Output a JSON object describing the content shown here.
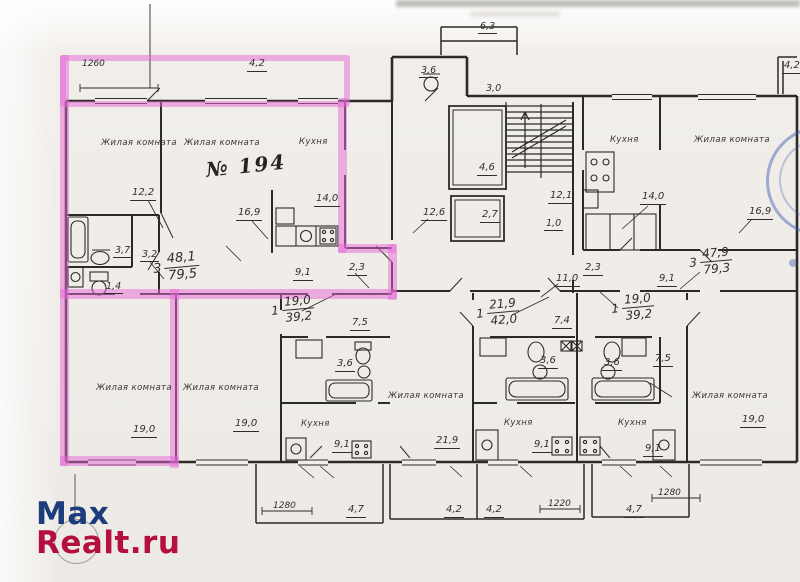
{
  "colors": {
    "highlight": "rgba(230,104,215,0.5)",
    "ink": "#2b2a27",
    "stamp_blue": "rgba(56,88,172,0.45)",
    "watermark_blue": "#1d3c7c",
    "watermark_red": "#b30f3f"
  },
  "watermark": {
    "line1": "Max",
    "line2": "Realt.ru"
  },
  "plan": {
    "apartment_number": "№ 194",
    "labels": [
      {
        "t": "1260",
        "x": 82,
        "y": 60,
        "fs": 9
      },
      {
        "t": "4,2",
        "x": 247,
        "y": 59,
        "fs": 10,
        "u": 1
      },
      {
        "t": "Жилая комната",
        "x": 101,
        "y": 139,
        "fs": 8.5,
        "room": 1
      },
      {
        "t": "Жилая комната",
        "x": 184,
        "y": 139,
        "fs": 8.5,
        "room": 1
      },
      {
        "t": "Кухня",
        "x": 299,
        "y": 138,
        "fs": 8.5,
        "room": 1
      },
      {
        "t": "№ 194",
        "x": 205,
        "y": 160,
        "fs": 20,
        "script": 1,
        "rot": -6
      },
      {
        "t": "12,2",
        "x": 130,
        "y": 188,
        "fs": 10,
        "u": 1
      },
      {
        "t": "16,9",
        "x": 236,
        "y": 208,
        "fs": 10,
        "u": 1
      },
      {
        "t": "14,0",
        "x": 314,
        "y": 194,
        "fs": 10,
        "u": 1
      },
      {
        "t": "3,7",
        "x": 113,
        "y": 246,
        "fs": 9.5,
        "u": 1
      },
      {
        "t": "3,2",
        "x": 140,
        "y": 250,
        "fs": 9.5,
        "u": 1
      },
      {
        "t": "1,4",
        "x": 104,
        "y": 282,
        "fs": 9.5,
        "u": 1
      },
      {
        "t": "9,1",
        "x": 293,
        "y": 268,
        "fs": 10,
        "u": 1
      },
      {
        "t": "2,3",
        "x": 347,
        "y": 263,
        "fs": 10,
        "u": 1
      },
      {
        "t": "7,5",
        "x": 350,
        "y": 318,
        "fs": 10,
        "u": 1
      },
      {
        "t": "3,6",
        "x": 335,
        "y": 359,
        "fs": 10,
        "u": 1
      },
      {
        "t": "Жилая комната",
        "x": 96,
        "y": 384,
        "fs": 8.5,
        "room": 1
      },
      {
        "t": "19,0",
        "x": 131,
        "y": 425,
        "fs": 10,
        "u": 1
      },
      {
        "t": "Жилая комната",
        "x": 183,
        "y": 384,
        "fs": 8.5,
        "room": 1
      },
      {
        "t": "19,0",
        "x": 233,
        "y": 419,
        "fs": 10,
        "u": 1
      },
      {
        "t": "Кухня",
        "x": 301,
        "y": 420,
        "fs": 8.5,
        "room": 1
      },
      {
        "t": "9,1",
        "x": 332,
        "y": 440,
        "fs": 10,
        "u": 1
      },
      {
        "t": "Жилая комната",
        "x": 388,
        "y": 392,
        "fs": 8.5,
        "room": 1
      },
      {
        "t": "21,9",
        "x": 434,
        "y": 436,
        "fs": 10,
        "u": 1
      },
      {
        "t": "7,4",
        "x": 552,
        "y": 316,
        "fs": 10,
        "u": 1
      },
      {
        "t": "3,6",
        "x": 538,
        "y": 356,
        "fs": 10,
        "u": 1
      },
      {
        "t": "3,6",
        "x": 602,
        "y": 358,
        "fs": 10,
        "u": 1
      },
      {
        "t": "Кухня",
        "x": 504,
        "y": 419,
        "fs": 8.5,
        "room": 1
      },
      {
        "t": "9,1",
        "x": 532,
        "y": 440,
        "fs": 10,
        "u": 1
      },
      {
        "t": "Кухня",
        "x": 618,
        "y": 419,
        "fs": 8.5,
        "room": 1
      },
      {
        "t": "9,1",
        "x": 643,
        "y": 444,
        "fs": 10,
        "u": 1
      },
      {
        "t": "11,0",
        "x": 554,
        "y": 274,
        "fs": 10,
        "u": 1
      },
      {
        "t": "2,3",
        "x": 583,
        "y": 263,
        "fs": 10,
        "u": 1
      },
      {
        "t": "9,1",
        "x": 657,
        "y": 274,
        "fs": 10,
        "u": 1
      },
      {
        "t": "7,5",
        "x": 653,
        "y": 354,
        "fs": 10,
        "u": 1
      },
      {
        "t": "Жилая комната",
        "x": 692,
        "y": 392,
        "fs": 8.5,
        "room": 1
      },
      {
        "t": "19,0",
        "x": 740,
        "y": 415,
        "fs": 10,
        "u": 1
      },
      {
        "t": "3,6",
        "x": 419,
        "y": 66,
        "fs": 9.5,
        "u": 1
      },
      {
        "t": "3,0",
        "x": 484,
        "y": 84,
        "fs": 9.5,
        "u": 1
      },
      {
        "t": "6,3",
        "x": 478,
        "y": 22,
        "fs": 9.5,
        "u": 1
      },
      {
        "t": "4,6",
        "x": 477,
        "y": 163,
        "fs": 10,
        "u": 1
      },
      {
        "t": "2,7",
        "x": 480,
        "y": 210,
        "fs": 10,
        "u": 1
      },
      {
        "t": "12,6",
        "x": 421,
        "y": 208,
        "fs": 10,
        "u": 1
      },
      {
        "t": "12,1",
        "x": 548,
        "y": 191,
        "fs": 10,
        "u": 1
      },
      {
        "t": "1,0",
        "x": 544,
        "y": 219,
        "fs": 9.5,
        "u": 1
      },
      {
        "t": "Кухня",
        "x": 610,
        "y": 136,
        "fs": 8.5,
        "room": 1
      },
      {
        "t": "Жилая комната",
        "x": 694,
        "y": 136,
        "fs": 8.5,
        "room": 1
      },
      {
        "t": "14,0",
        "x": 640,
        "y": 192,
        "fs": 10,
        "u": 1
      },
      {
        "t": "16,9",
        "x": 747,
        "y": 207,
        "fs": 10,
        "u": 1
      },
      {
        "t": "1280",
        "x": 273,
        "y": 502,
        "fs": 9
      },
      {
        "t": "4,7",
        "x": 346,
        "y": 505,
        "fs": 10,
        "u": 1
      },
      {
        "t": "4,2",
        "x": 444,
        "y": 505,
        "fs": 10,
        "u": 1
      },
      {
        "t": "4,2",
        "x": 484,
        "y": 505,
        "fs": 10,
        "u": 1
      },
      {
        "t": "1220",
        "x": 548,
        "y": 500,
        "fs": 9
      },
      {
        "t": "4,7",
        "x": 624,
        "y": 505,
        "fs": 10,
        "u": 1
      },
      {
        "t": "1280",
        "x": 658,
        "y": 489,
        "fs": 9
      },
      {
        "t": "4,2",
        "x": 782,
        "y": 61,
        "fs": 10,
        "u": 1
      }
    ],
    "area_fractions": [
      {
        "p": "3",
        "top": "48,1",
        "bot": "79,5",
        "x": 152,
        "y": 254,
        "fs": 13,
        "rot": -5
      },
      {
        "p": "1",
        "top": "19,0",
        "bot": "39,2",
        "x": 270,
        "y": 297,
        "fs": 12,
        "rot": -5
      },
      {
        "p": "1",
        "top": "21,9",
        "bot": "42,0",
        "x": 475,
        "y": 300,
        "fs": 12,
        "rot": -5
      },
      {
        "p": "3",
        "top": "47,9",
        "bot": "79,3",
        "x": 688,
        "y": 249,
        "fs": 12,
        "rot": -5
      },
      {
        "p": "1",
        "top": "19,0",
        "bot": "39,2",
        "x": 610,
        "y": 295,
        "fs": 12,
        "rot": -5
      }
    ]
  }
}
